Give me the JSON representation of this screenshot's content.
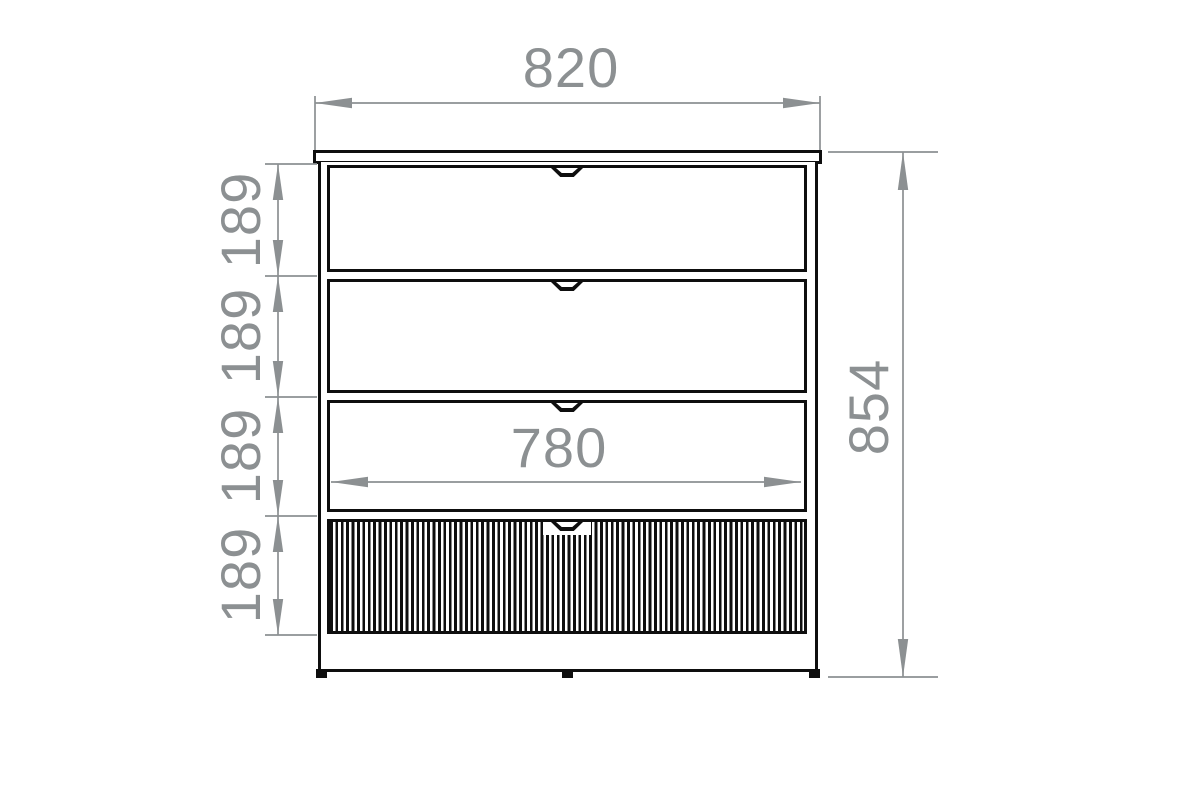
{
  "diagram": {
    "subject": "chest-of-drawers-front-elevation",
    "drawer_count": 4,
    "bottom_drawer_finish": "vertical-fluting",
    "labels": {
      "overall_width": "820",
      "overall_height": "854",
      "inner_drawer_width": "780",
      "drawer_heights": [
        "189",
        "189",
        "189",
        "189"
      ]
    },
    "colors": {
      "outline": "#0e0e0e",
      "dimension": "#8c9092",
      "background": "#ffffff"
    }
  }
}
